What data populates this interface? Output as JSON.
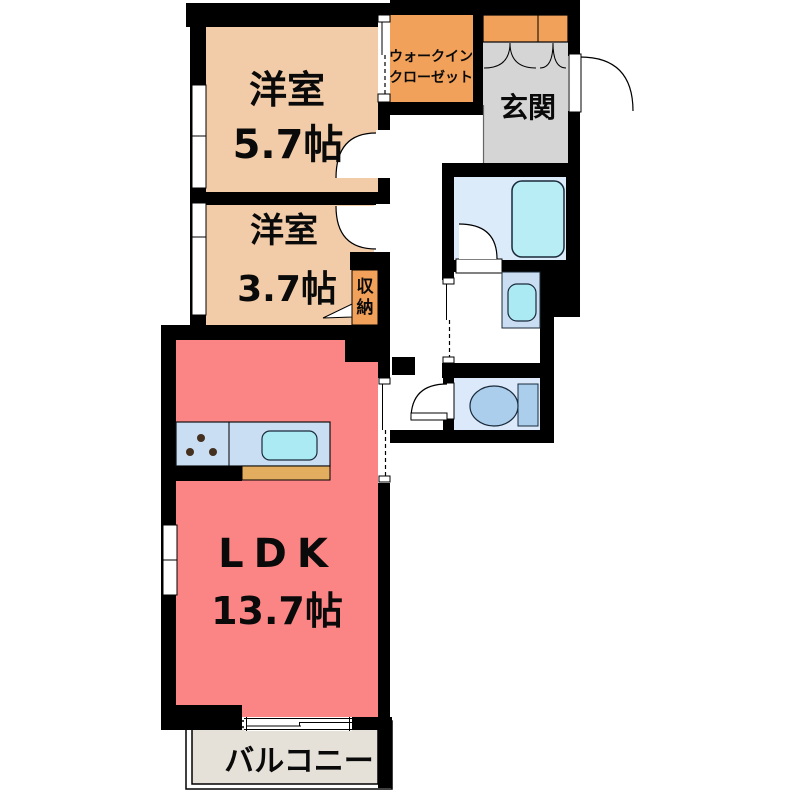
{
  "rooms": {
    "bedroom1": {
      "name": "洋室",
      "size": "5.7帖"
    },
    "bedroom2": {
      "name": "洋室",
      "size": "3.7帖"
    },
    "ldk": {
      "name": "LDK",
      "size": "13.7帖"
    },
    "walk_in_closet": {
      "line1": "ウォークイン",
      "line2": "クローゼット"
    },
    "entrance": {
      "name": "玄関"
    },
    "storage": {
      "name": "収納",
      "chars": [
        "収",
        "納"
      ]
    },
    "balcony": {
      "name": "バルコニー"
    }
  },
  "colors": {
    "wall": "#000000",
    "bedroom": "#f2cca8",
    "ldk": "#fb8484",
    "closet_orange": "#f1a159",
    "entrance_gray": "#d5d5d5",
    "bath_floor": "#dcebfa",
    "bathtub": "#b9edf5",
    "vanity": "#c9ddf3",
    "sink": "#abe9f3",
    "toilet_floor": "#dbe9fb",
    "toilet_fixture": "#abceec",
    "kitchen_counter": "#c9ddf3",
    "counter_front": "#e3ad60",
    "balcony_floor": "#e5e1d9"
  }
}
